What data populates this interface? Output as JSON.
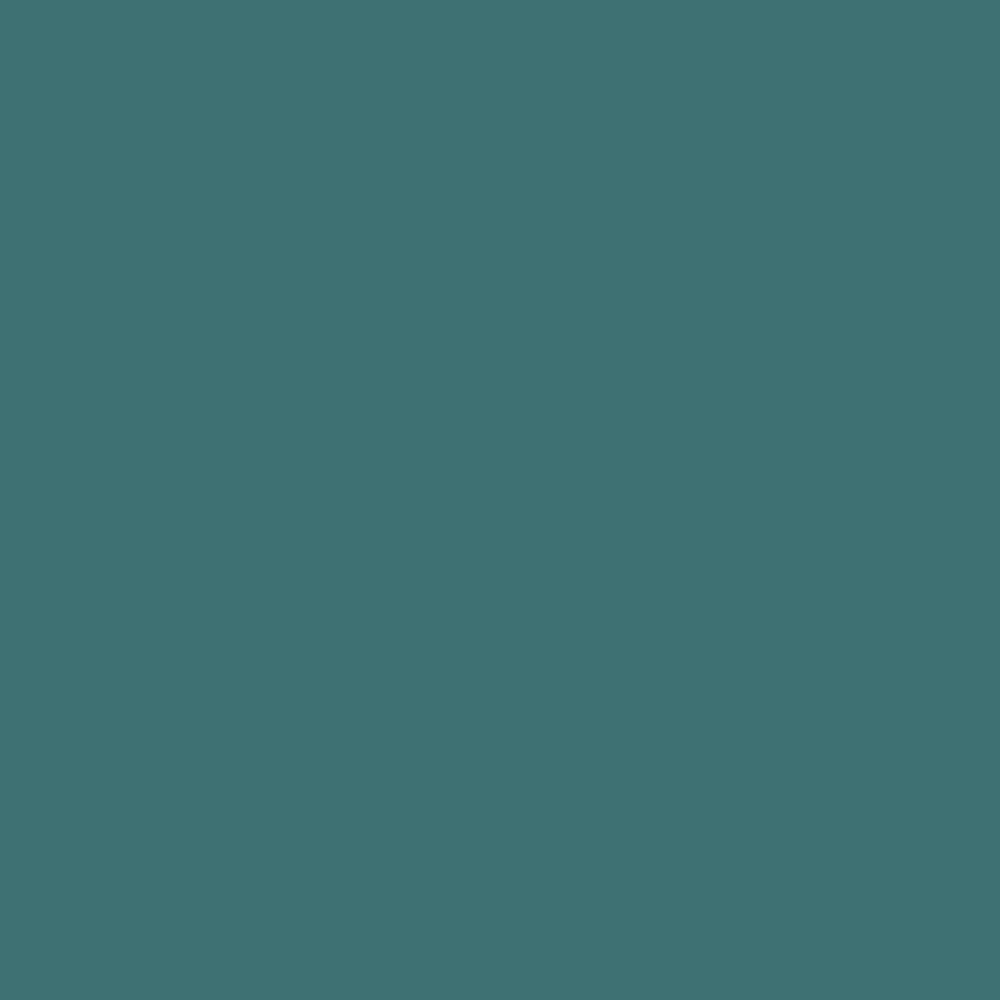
{
  "canvas": {
    "background_color": "#3E7173",
    "description": "uniform solid teal fill, no visible text or UI elements"
  }
}
